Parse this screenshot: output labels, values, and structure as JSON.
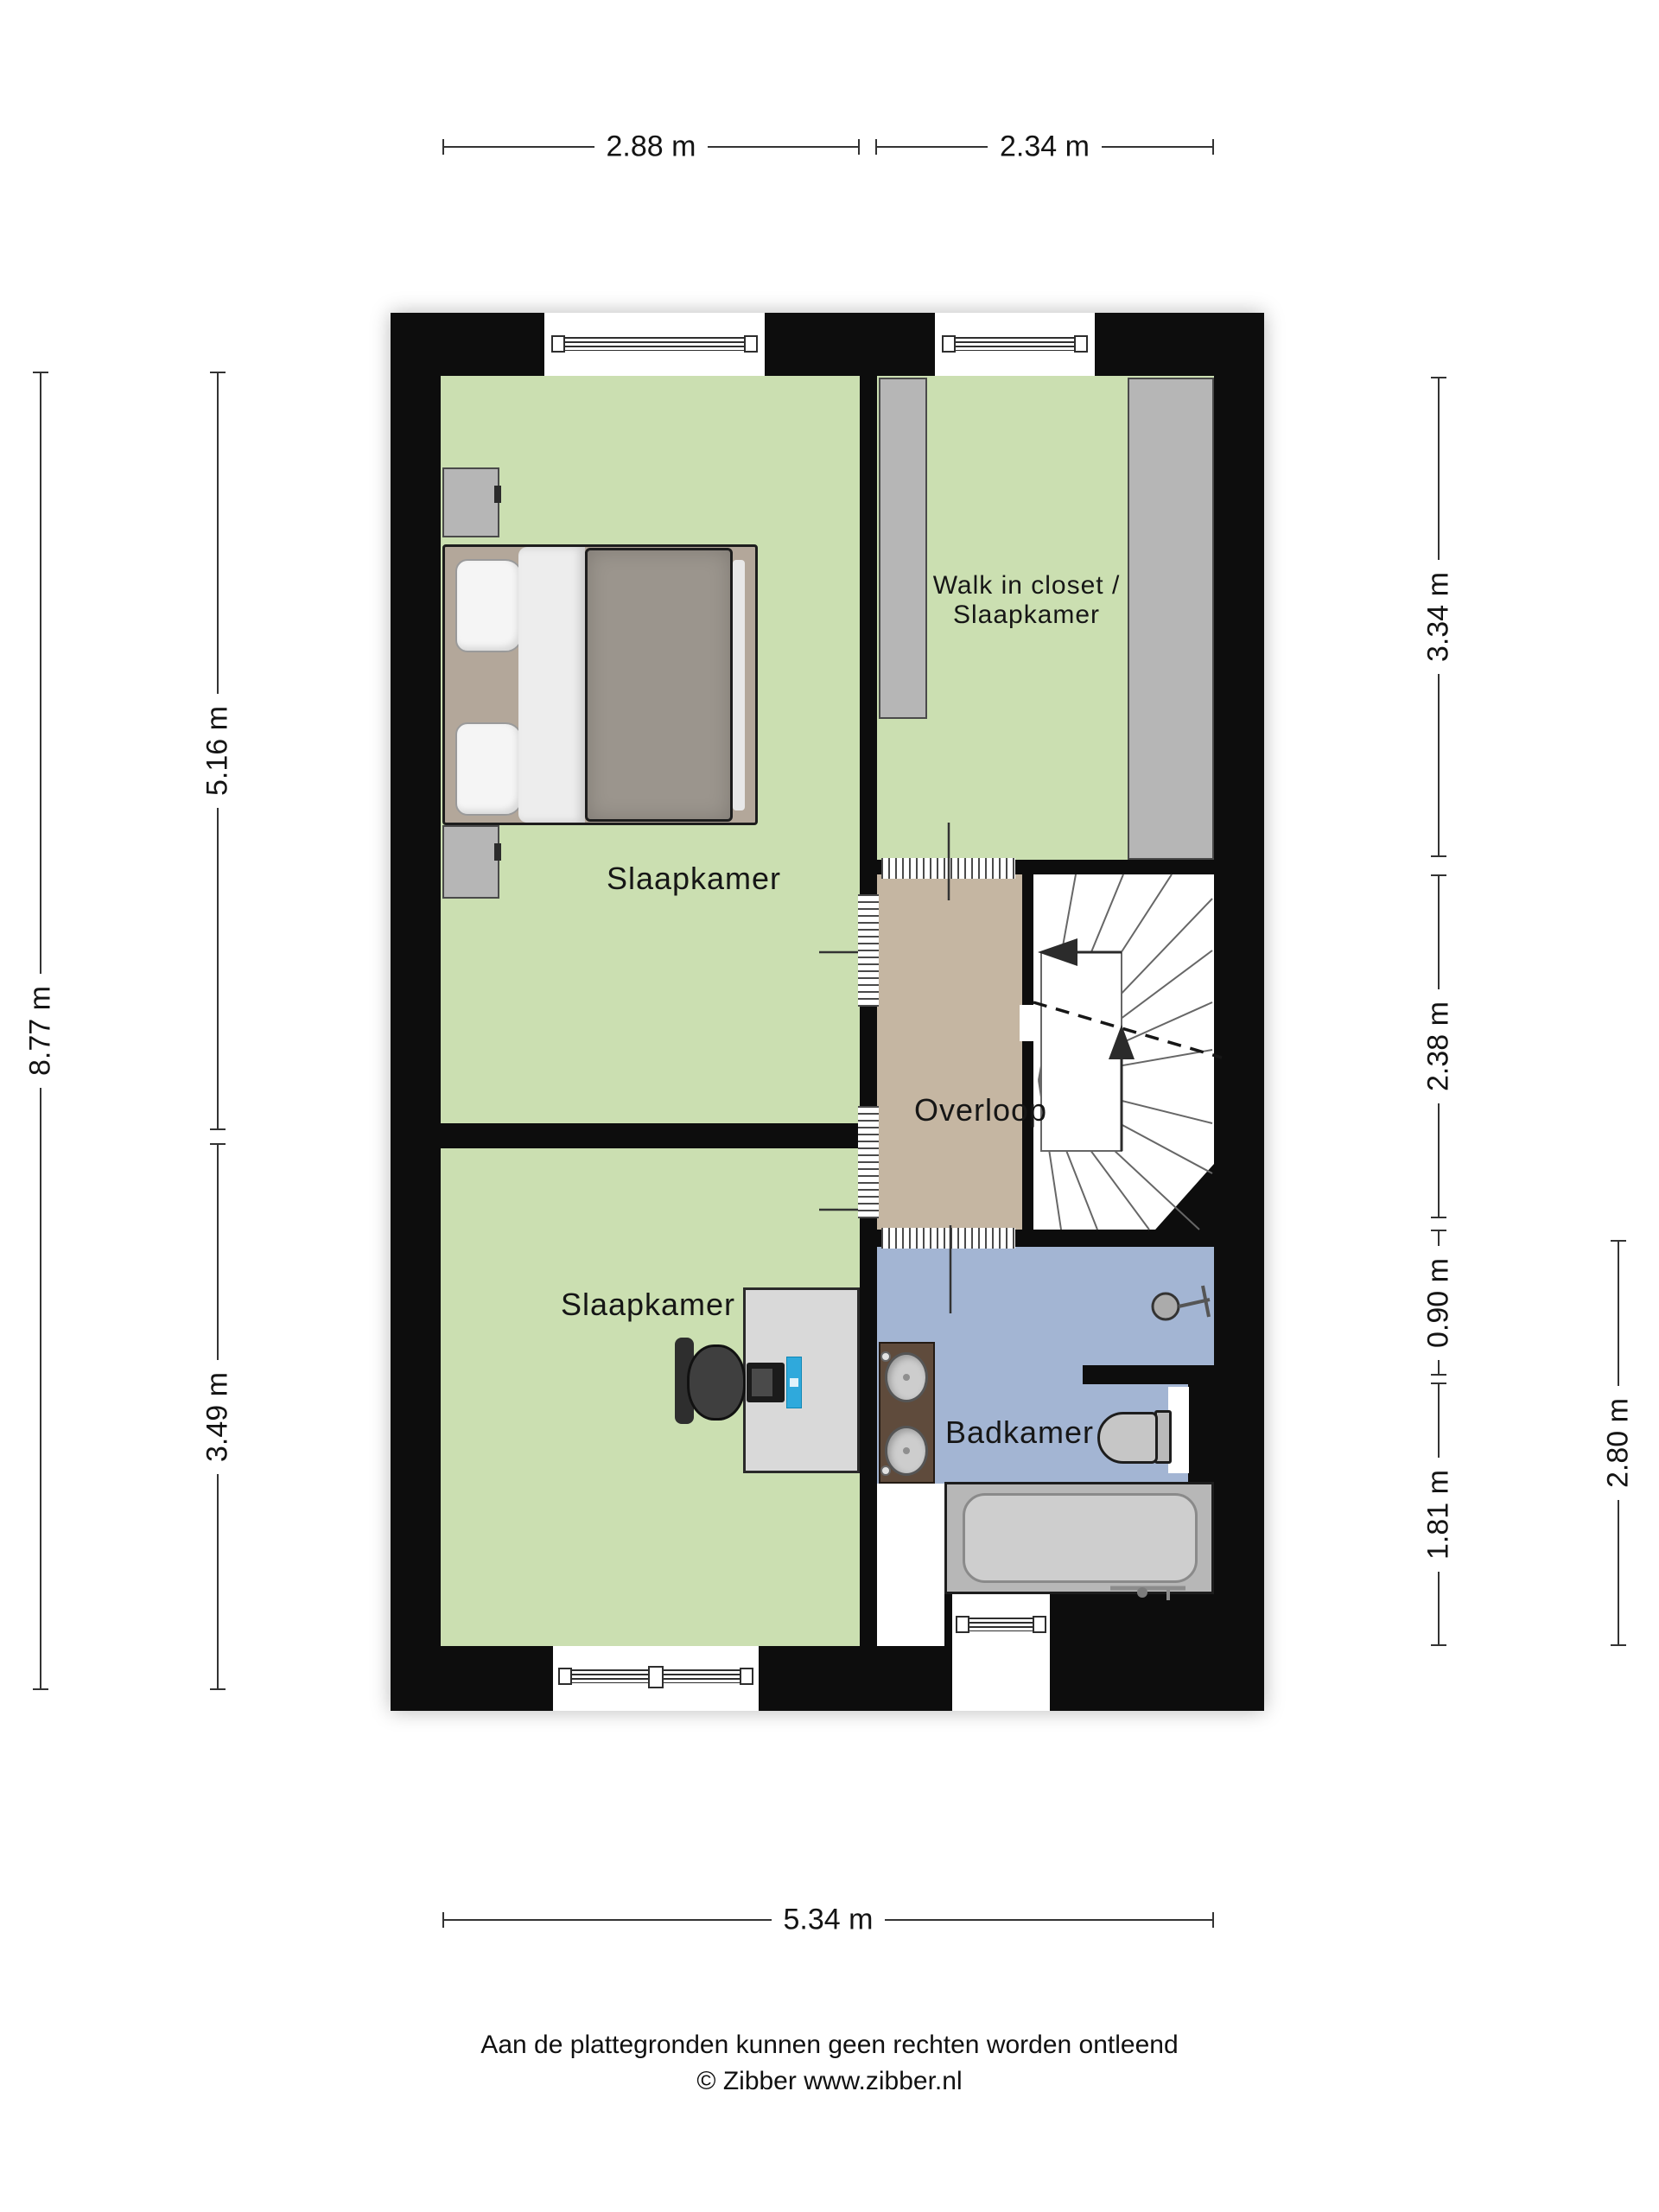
{
  "rooms": {
    "bedroom_top": {
      "label": "Slaapkamer"
    },
    "walk_in_closet": {
      "line1": "Walk in closet /",
      "line2": "Slaapkamer"
    },
    "landing": {
      "label": "Overloop"
    },
    "bedroom_bottom": {
      "label": "Slaapkamer"
    },
    "bathroom": {
      "label": "Badkamer"
    }
  },
  "dimensions": {
    "top": [
      "2.88 m",
      "2.34 m"
    ],
    "left": [
      "8.77 m",
      "5.16 m",
      "3.49 m"
    ],
    "right": [
      "3.34 m",
      "2.38 m",
      "0.90 m",
      "1.81 m",
      "2.80 m"
    ],
    "bottom": [
      "5.34 m"
    ]
  },
  "footer": {
    "line1": "Aan de plattegronden kunnen geen rechten worden ontleend",
    "line2": "© Zibber www.zibber.nl"
  },
  "icons": {
    "double-bed": "css-shape",
    "nightstand": "css-shape",
    "wardrobe": "css-shape",
    "desk": "css-shape",
    "office-chair": "css-shape",
    "laptop": "css-shape",
    "monitor": "css-shape",
    "stairs": "svg-lines",
    "toilet": "css-shape",
    "bathtub": "css-shape",
    "vanity-sinks": "css-shape",
    "shower-head": "svg-shape",
    "window": "css-lines",
    "door-threshold": "css-lines"
  },
  "colors": {
    "wall": "#0d0d0d",
    "room-floor": "#cbdfb1",
    "landing-floor": "#c5b6a2",
    "bathroom-floor": "#a3b5d3",
    "furniture-gray": "#b6b6b6",
    "desk": "#d9d9d9",
    "bed-frame": "#b3a79a",
    "duvet": "#9b958d",
    "vanity": "#5f4b3c",
    "accent-blue": "#2fa9dc"
  }
}
